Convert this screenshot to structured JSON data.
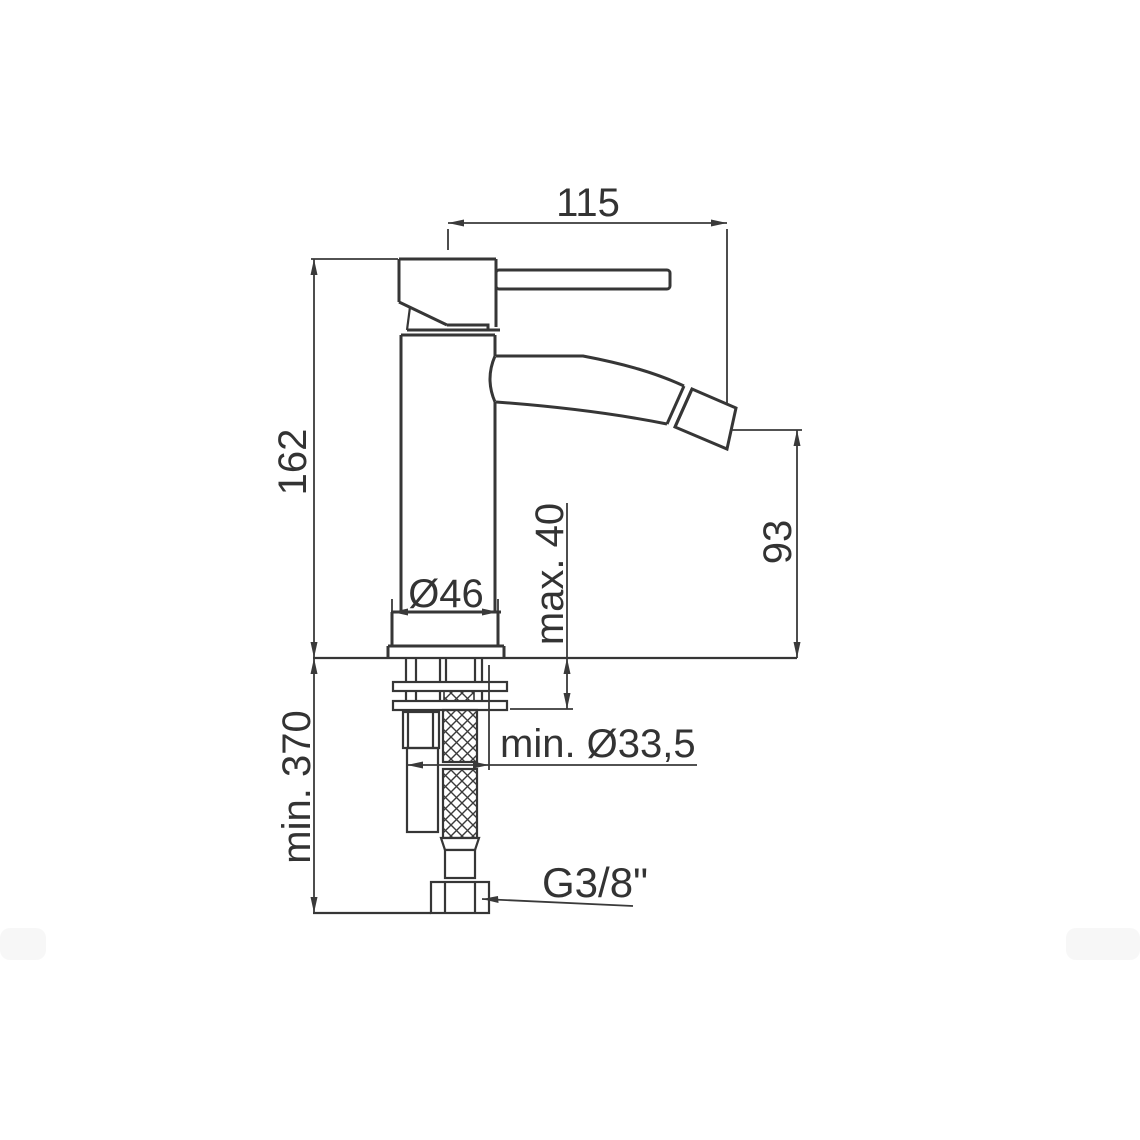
{
  "page": {
    "background_color": "#ffffff",
    "line_color": "#363636",
    "text_color": "#333333"
  },
  "drawing": {
    "type": "technical-dimension-drawing",
    "subject": "single-lever bidet mixer tap, side elevation with flexible supply hoses",
    "dimensions": {
      "handle_reach": {
        "label": "115"
      },
      "body_height": {
        "label": "162"
      },
      "spout_height": {
        "label": "93"
      },
      "max_deck_thickness": {
        "label": "max. 40"
      },
      "base_diameter": {
        "label": "Ø46"
      },
      "min_hose_length": {
        "label": "min. 370"
      },
      "min_hole_diameter": {
        "label": "min. Ø33,5"
      },
      "connection_thread": {
        "label": "G3/8\""
      }
    }
  }
}
